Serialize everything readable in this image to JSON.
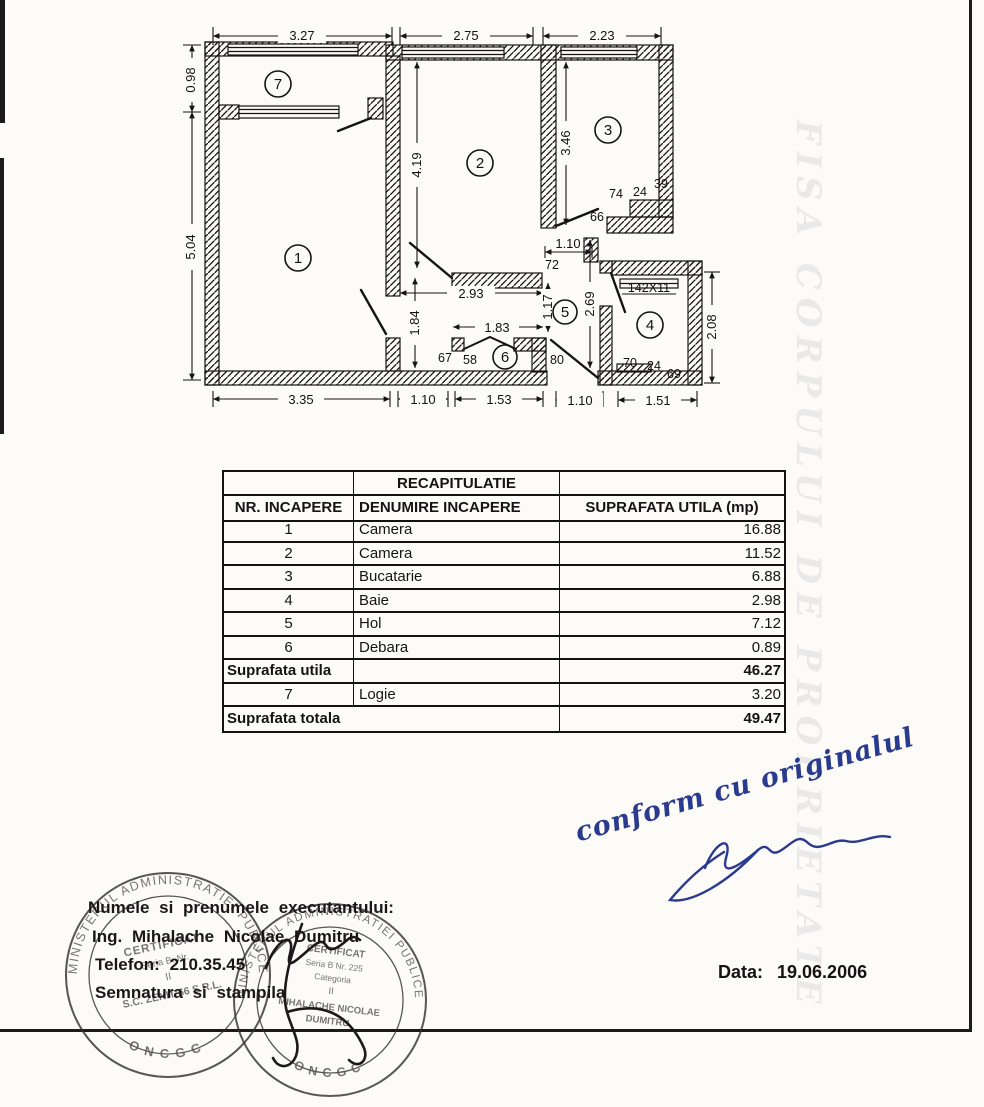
{
  "page": {
    "bleed_text": "FISA CORPULUI DE PROPRIETATE"
  },
  "plan": {
    "rooms": [
      "1",
      "2",
      "3",
      "4",
      "5",
      "6",
      "7"
    ],
    "dims": {
      "top1": "3.27",
      "top2": "2.75",
      "top3": "2.23",
      "left1": "0.98",
      "left2": "5.04",
      "v419": "4.19",
      "v346": "3.46",
      "v184": "1.84",
      "v117": "1.17",
      "v269": "2.69",
      "v208": "2.08",
      "h293": "2.93",
      "h183": "1.83",
      "h110": "1.10",
      "n72": "72",
      "n66": "66",
      "n74": "74",
      "n24a": "24",
      "n39": "39",
      "n67": "67",
      "n58": "58",
      "n80": "80",
      "n70": "70",
      "n24b": "24",
      "n69": "69",
      "n142": "142X11",
      "b1": "3.35",
      "b2": "1.10",
      "b3": "1.53",
      "b4": "1.10",
      "b5": "1.51"
    }
  },
  "table": {
    "title": "RECAPITULATIE",
    "headers": [
      "NR. INCAPERE",
      "DENUMIRE INCAPERE",
      "SUPRAFATA UTILA (mp)"
    ],
    "rows": [
      {
        "nr": "1",
        "name": "Camera",
        "area": "16.88"
      },
      {
        "nr": "2",
        "name": "Camera",
        "area": "11.52"
      },
      {
        "nr": "3",
        "name": "Bucatarie",
        "area": "6.88"
      },
      {
        "nr": "4",
        "name": "Baie",
        "area": "2.98"
      },
      {
        "nr": "5",
        "name": "Hol",
        "area": "7.12"
      },
      {
        "nr": "6",
        "name": "Debara",
        "area": "0.89"
      }
    ],
    "subtotal_label": "Suprafata utila",
    "subtotal_value": "46.27",
    "row7": {
      "nr": "7",
      "name": "Logie",
      "area": "3.20"
    },
    "total_label": "Suprafata totala",
    "total_value": "49.47"
  },
  "handwriting": {
    "note": "conform cu originalul"
  },
  "stamps": {
    "ring_text": "MINISTERUL ADMINISTRATIEI PUBLICE",
    "oncgc": "ONCGC",
    "s1_line1": "CERTIFICAT",
    "s1_line2": "Seria B. Nr.",
    "s1_line3": "II",
    "s1_line4": "S.C. ZENIT 66 S.R.L.",
    "s2_line1": "CERTIFICAT",
    "s2_line2": "Seria B Nr. 225",
    "s2_line3": "Categoria",
    "s2_line4": "II",
    "s2_line5": "MIHALACHE NICOLAE",
    "s2_line6": "DUMITRU"
  },
  "footer": {
    "executor_label": "Numele si prenumele executantului:",
    "executor_name": "Ing. Mihalache Nicolae Dumitru",
    "phone": "Telefon: 210.35.45",
    "signature_label": "Semnatura si stampila",
    "date_label": "Data:",
    "date_value": "19.06.2006"
  }
}
